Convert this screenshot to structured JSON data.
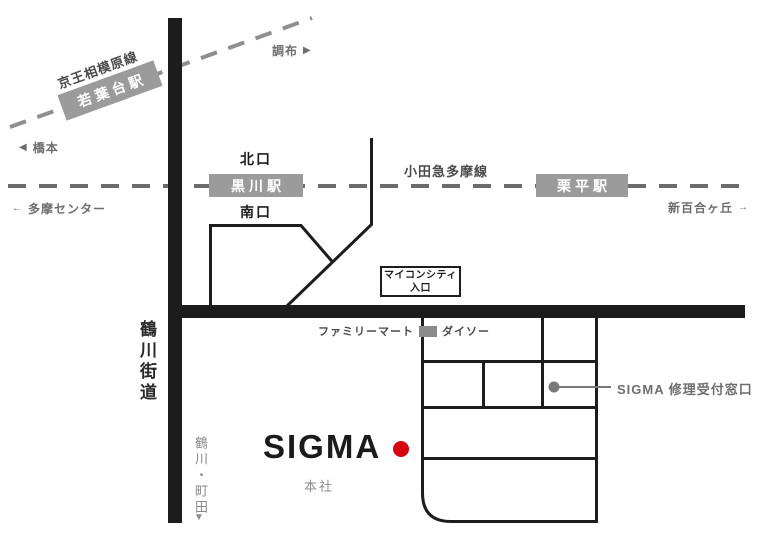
{
  "railways": {
    "keio": {
      "line_name": "京王相模原線",
      "station": "若葉台駅",
      "terminal_left": "橋本",
      "terminal_right": "調布",
      "arrow_left": "◀",
      "arrow_right": "▶"
    },
    "odakyu": {
      "line_name": "小田急多摩線",
      "station_kurokawa": "黒川駅",
      "exit_north": "北口",
      "exit_south": "南口",
      "station_kurihira": "栗平駅",
      "terminal_left": "多摩センター",
      "terminal_right": "新百合ヶ丘",
      "arrow_left": "←",
      "arrow_right": "→"
    }
  },
  "roads": {
    "vertical_road_name": "鶴川街道",
    "south_destinations": "鶴川・町田",
    "arrow_down": "▼"
  },
  "landmarks": {
    "entrance_sign_line1": "マイコンシティ",
    "entrance_sign_line2": "入口",
    "familymart": "ファミリーマート",
    "daiso": "ダイソー",
    "repair_window": "SIGMA 修理受付窓口"
  },
  "sigma": {
    "logo": "SIGMA",
    "headquarters": "本社"
  },
  "colors": {
    "road_black": "#1d1d1d",
    "keio_rail_gray": "#8f8f8f",
    "odakyu_rail_gray": "#6b6b6b",
    "station_box_bg": "#9b9b9b",
    "station_box_text": "#ffffff",
    "gray_text": "#6e6e6e",
    "light_gray_text": "#8a8a8a",
    "red_marker": "#d7000f",
    "repair_marker_gray": "#787878"
  }
}
